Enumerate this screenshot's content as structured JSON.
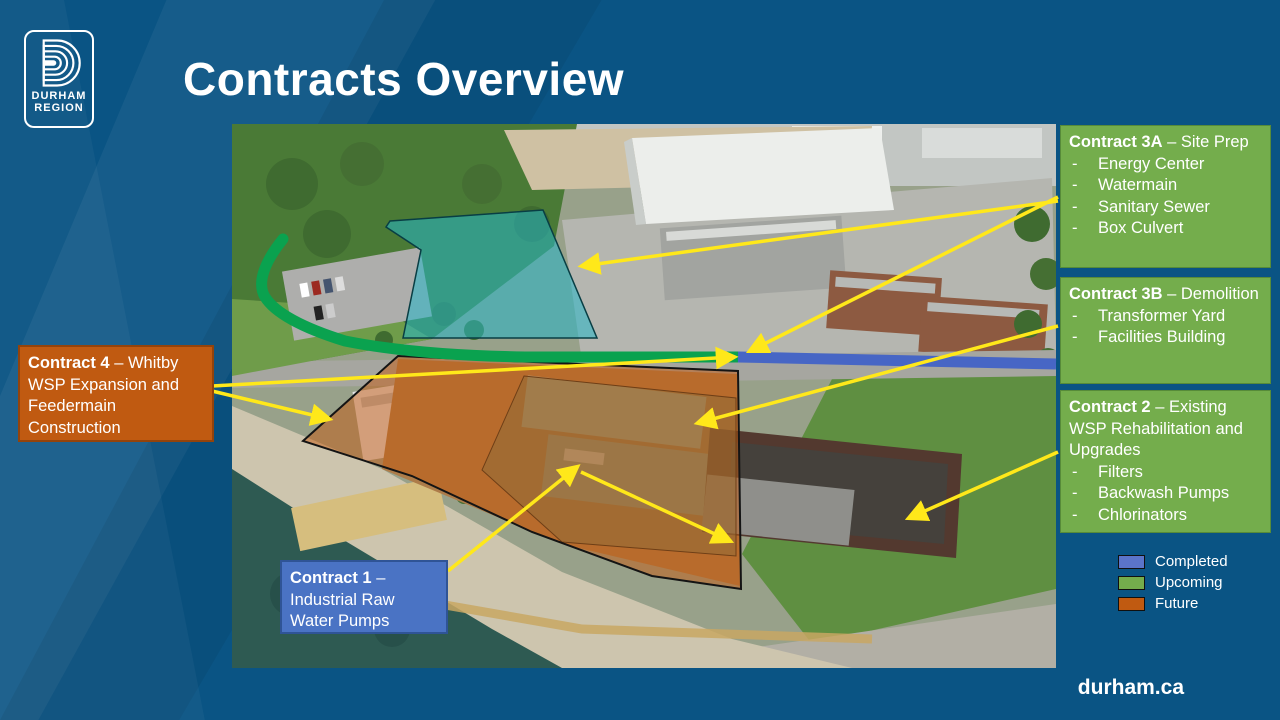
{
  "slide": {
    "title": "Contracts Overview",
    "footer": "durham.ca"
  },
  "logo": {
    "line1": "DURHAM",
    "line2": "REGION"
  },
  "bullet": "-",
  "callouts": {
    "contract_3a": {
      "title_bold": "Contract 3A",
      "title_rest": " – Site Prep",
      "items": [
        "Energy Center",
        "Watermain",
        "Sanitary Sewer",
        "Box Culvert"
      ]
    },
    "contract_3b": {
      "title_bold": "Contract 3B",
      "title_rest": " – Demolition",
      "items": [
        "Transformer Yard",
        "Facilities Building"
      ]
    },
    "contract_2": {
      "title_bold": "Contract 2",
      "title_rest": " – Existing WSP Rehabilitation and Upgrades",
      "items": [
        "Filters",
        "Backwash Pumps",
        "Chlorinators"
      ]
    },
    "contract_4": {
      "title_bold": "Contract 4",
      "title_rest": " – Whitby WSP Expansion and Feedermain Construction",
      "items": []
    },
    "contract_1": {
      "title_bold": "Contract 1",
      "title_rest": " – Industrial Raw Water Pumps",
      "items": []
    }
  },
  "legend": {
    "items": [
      {
        "label": "Completed",
        "color": "#5b74c9"
      },
      {
        "label": "Upcoming",
        "color": "#74ad4c"
      },
      {
        "label": "Future",
        "color": "#c05a11"
      }
    ]
  },
  "colors": {
    "slide_background": "#0a5484",
    "callout_green": "#74ad4c",
    "callout_orange": "#c05a11",
    "callout_blue": "#4a73c4",
    "route_green": "#0aa24f",
    "route_blue": "#4766c5",
    "arrow_yellow": "#ffe81a",
    "site_teal": "#27b6c9"
  }
}
